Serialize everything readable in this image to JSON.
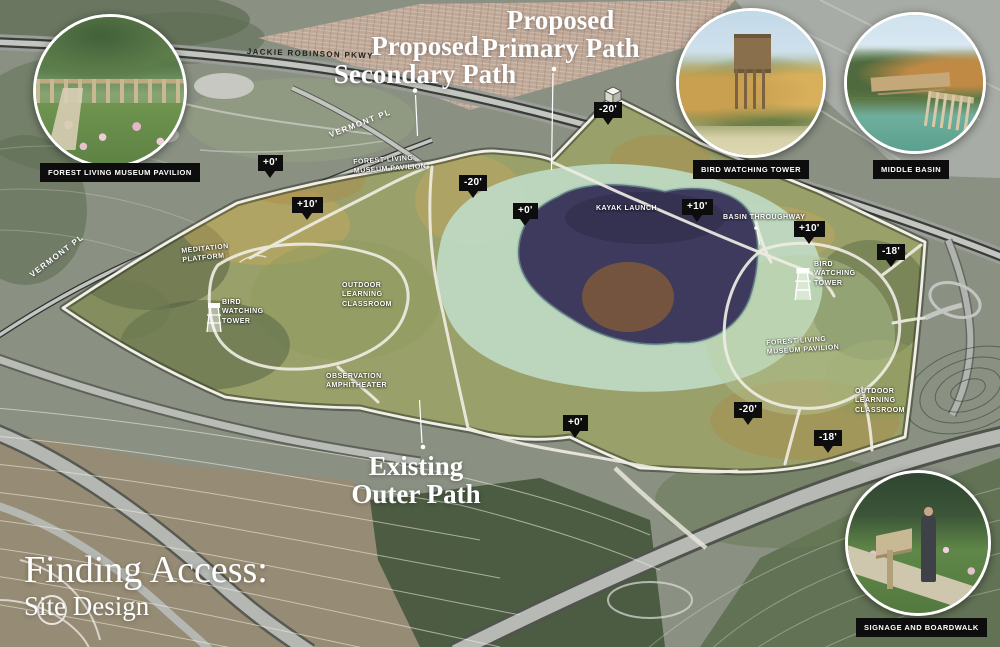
{
  "title": {
    "line1": "Finding Access:",
    "line2": "Site Design"
  },
  "annotations": {
    "secondary_path": "Proposed\nSecondary Path",
    "primary_path": "Proposed\nPrimary Path",
    "outer_path": "Existing\nOuter Path"
  },
  "insets": {
    "pavilion": {
      "label": "FOREST LIVING MUSEUM PAVILION"
    },
    "tower": {
      "label": "BIRD WATCHING TOWER"
    },
    "basin": {
      "label": "MIDDLE BASIN"
    },
    "signage": {
      "label": "SIGNAGE AND BOARDWALK"
    }
  },
  "roads": {
    "jackie_robinson": "JACKIE ROBINSON PKWY",
    "vermont_upper": "VERMONT PL",
    "vermont_left": "VERMONT PL"
  },
  "site_labels": {
    "flmp_west": "FOREST LIVING\nMUSEUM PAVILION",
    "meditation": "MEDITATION\nPLATFORM",
    "olc_west": "OUTDOOR\nLEARNING\nCLASSROOM",
    "bwt_west": "BIRD\nWATCHING\nTOWER",
    "amphitheater": "OBSERVATION\nAMPHITHEATER",
    "kayak": "KAYAK LAUNCH",
    "basin_throughway": "BASIN THROUGHWAY",
    "bwt_east": "BIRD\nWATCHING\nTOWER",
    "flmp_east": "FOREST LIVING\nMUSEUM PAVILION",
    "olc_east": "OUTDOOR\nLEARNING\nCLASSROOM"
  },
  "elevation_markers": [
    {
      "value": "+0'"
    },
    {
      "value": "+10'"
    },
    {
      "value": "-20'"
    },
    {
      "value": "-20'"
    },
    {
      "value": "+0'"
    },
    {
      "value": "+10'"
    },
    {
      "value": "+10'"
    },
    {
      "value": "-18'"
    },
    {
      "value": "-20'"
    },
    {
      "value": "-18'"
    },
    {
      "value": "+0'"
    }
  ],
  "icons": {
    "cube": "elevation-cube-icon",
    "tower_west": "bird-tower-icon",
    "tower_east": "bird-tower-icon"
  },
  "colors": {
    "marker_bg": "#0d0d0d",
    "label_bar_bg": "#0d0d0d",
    "label_text": "#ffffff",
    "lake": "#3d3a5e",
    "marsh": "#bed9c2",
    "path": "#efece2",
    "site_base": "#9aa06a",
    "road": "#c3c5c0"
  }
}
